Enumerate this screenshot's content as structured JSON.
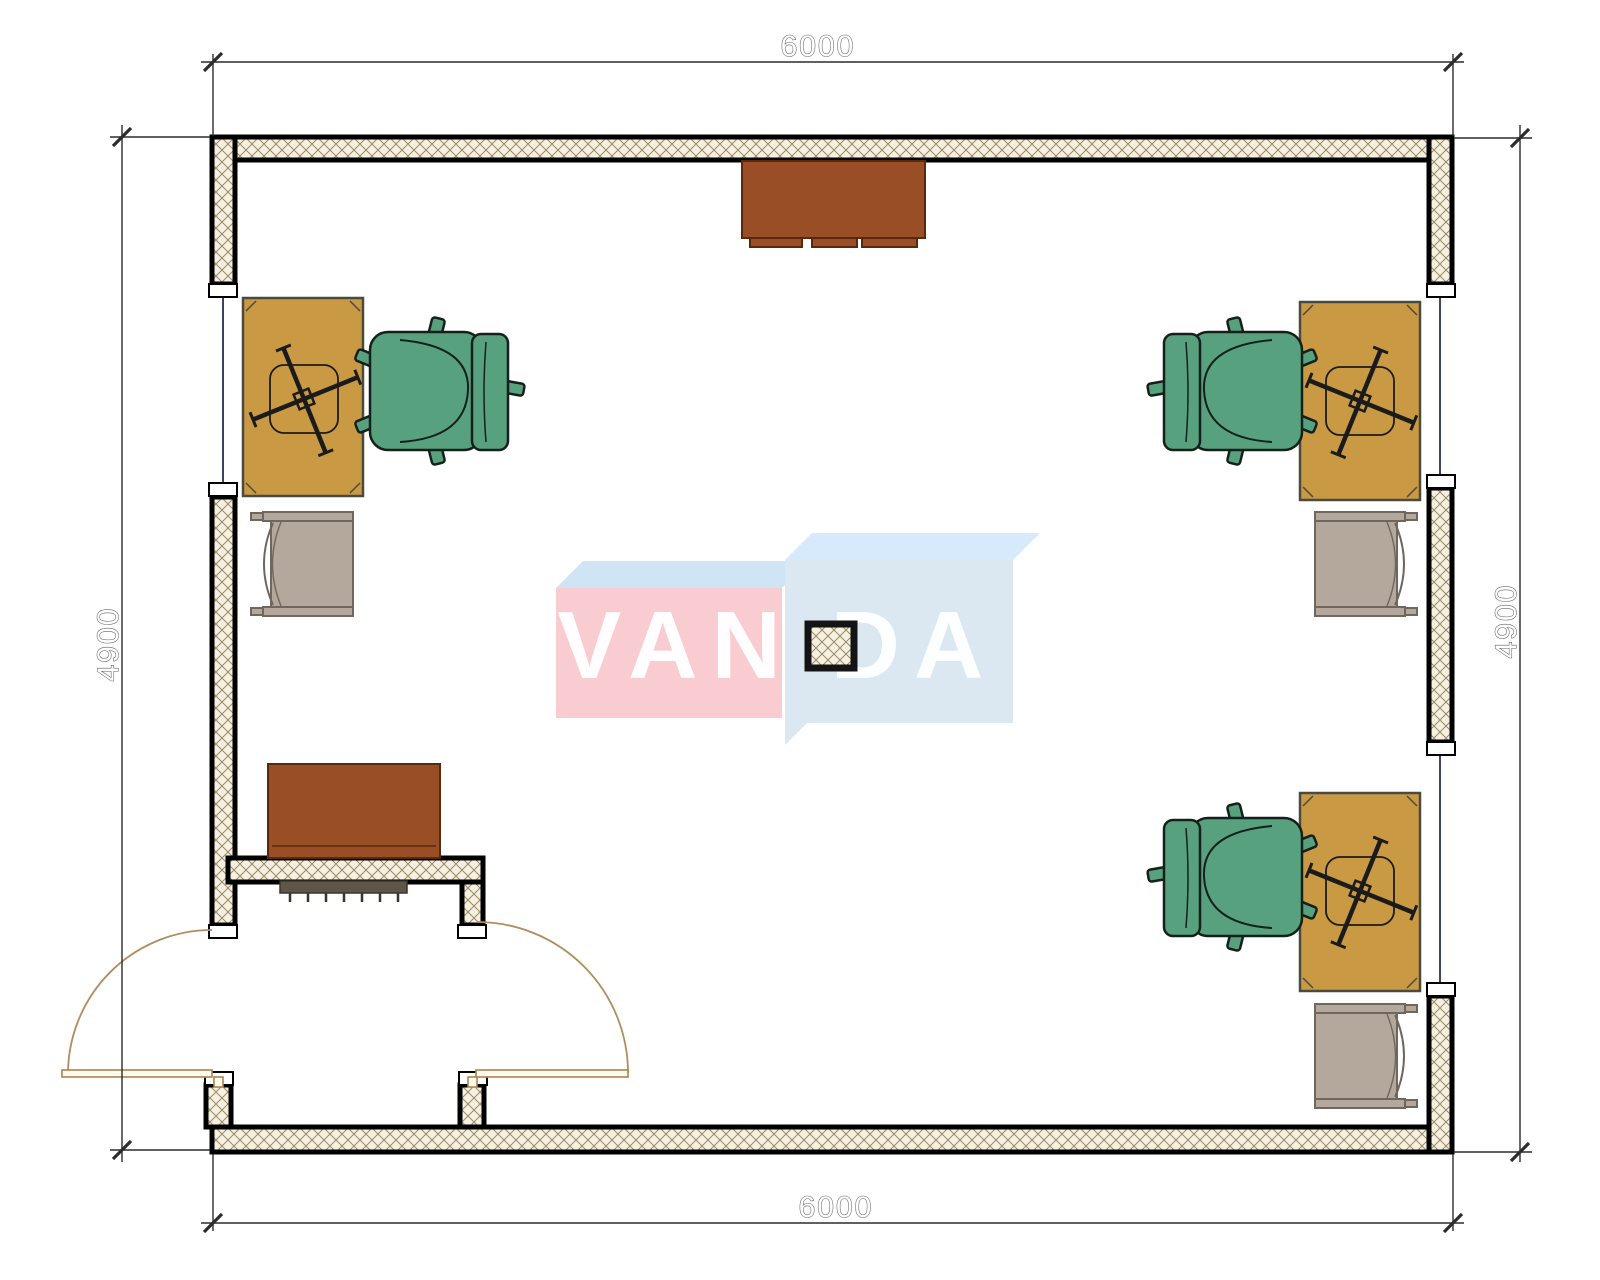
{
  "drawing": {
    "type": "office floor plan",
    "dimensions": {
      "top": "6000",
      "bottom": "6000",
      "left": "4900",
      "right": "4900"
    },
    "watermark": {
      "left": "VAN",
      "right": "DA",
      "full": "VANDA"
    }
  },
  "colors": {
    "wall_hatch_bg": "#f5f0e1",
    "wall_hatch_line": "#9a8c63",
    "wall_border": "#000000",
    "desk": "#c99a43",
    "chair_green": "#57a17e",
    "chair_gray": "#b3a89b",
    "cabinet": "#9a4e25",
    "radiator": "#5e5747",
    "door_arc": "#b08d5e",
    "door_leaf": "#a8854f",
    "window_line": "#3a4563",
    "dim_line": "#2b2b2b",
    "watermark_pink": "#f8ccd1",
    "watermark_blue_front": "#dbe7f1",
    "watermark_blue_top": "#cfe4f5",
    "watermark_blue_top_right": "#d6eafc"
  }
}
